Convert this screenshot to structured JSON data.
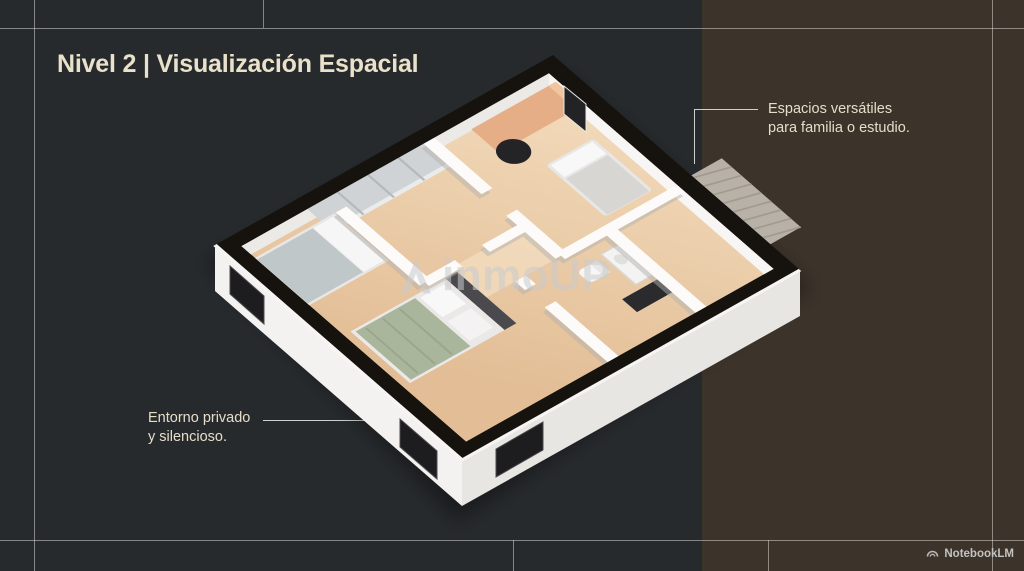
{
  "slide": {
    "title": "Nivel 2 | Visualización Espacial",
    "colors": {
      "background": "#272a2d",
      "accent_band": "#3c332b",
      "title_text": "#eae1cb",
      "annotation_text": "#e6ddc8",
      "frame_lines": "#e1e4dd",
      "connector_lines": "#cdd1cb"
    }
  },
  "annotations": {
    "right": {
      "line1": "Espacios versátiles",
      "line2": "para familia o estudio."
    },
    "left": {
      "line1": "Entorno privado",
      "line2": "y silencioso."
    }
  },
  "floorplan": {
    "style": "isometric-3d-render",
    "watermark": {
      "icon": "inmoup-logo-icon",
      "text": "inmoUP"
    },
    "colors": {
      "floor_wood": "#ecd0ac",
      "wall_top": "#16130f",
      "wall_face": "#f4f3f1",
      "terrace_concrete": "#b7b1a7",
      "desk_wood": "#e6ae86",
      "bed_blanket_green": "#a9b69b",
      "bed_blanket_gray": "#c0c7c8",
      "window_glass": "#1d1d1f"
    },
    "elements": [
      "desk",
      "office-chair",
      "single-bed",
      "double-bed-green",
      "double-bed-gray",
      "wardrobe",
      "bathroom-fixtures",
      "terrace",
      "windows",
      "tv-panel"
    ]
  },
  "footer": {
    "brand": "NotebookLM",
    "icon": "notebooklm-logo-icon"
  }
}
